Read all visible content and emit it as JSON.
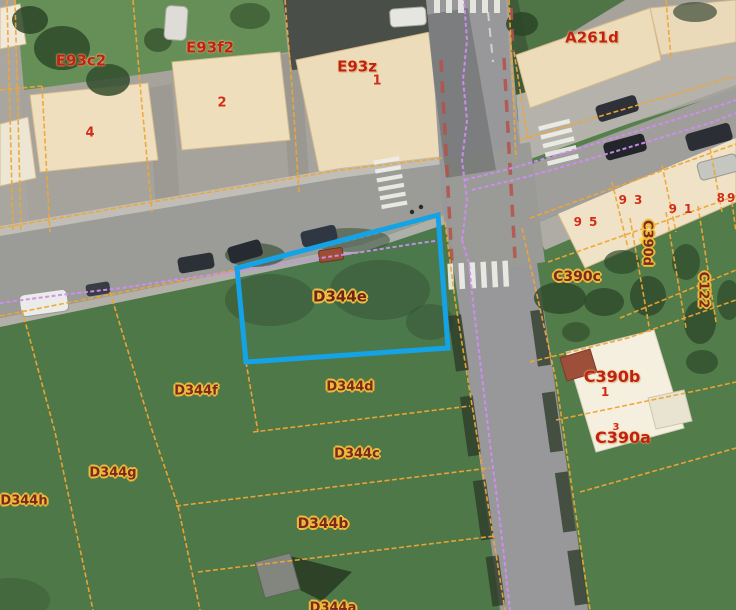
{
  "map": {
    "type": "aerial-cadastral-view",
    "selected_parcel": {
      "id": "D344e",
      "outline_color": "#15a3e8"
    },
    "colors": {
      "parcel_boundary_line": "#efa636",
      "utility_line": "#d08df2",
      "road_marking_red": "#b5524a",
      "selection_blue": "#15a3e8",
      "field_label_text": "#7b2a1e",
      "field_label_halo": "#eebb3a",
      "building_label_text": "#c0201a"
    },
    "labels": [
      {
        "id": "E93c2",
        "text": "E93c2",
        "x": 81,
        "y": 61,
        "style": "building",
        "size": 15
      },
      {
        "id": "house-4",
        "text": "4",
        "x": 90,
        "y": 133,
        "style": "number",
        "size": 13
      },
      {
        "id": "E93f2",
        "text": "E93f2",
        "x": 210,
        "y": 48,
        "style": "building",
        "size": 15
      },
      {
        "id": "house-2",
        "text": "2",
        "x": 222,
        "y": 103,
        "style": "number",
        "size": 13
      },
      {
        "id": "E93z",
        "text": "E93z",
        "x": 357,
        "y": 67,
        "style": "building",
        "size": 15
      },
      {
        "id": "house-1",
        "text": "1",
        "x": 377,
        "y": 81,
        "style": "number",
        "size": 13
      },
      {
        "id": "A261d",
        "text": "A261d",
        "x": 592,
        "y": 38,
        "style": "building",
        "size": 15
      },
      {
        "id": "no-95",
        "text": "95",
        "x": 589,
        "y": 222,
        "style": "number",
        "size": 12,
        "ls": 7
      },
      {
        "id": "no-93",
        "text": "93",
        "x": 634,
        "y": 200,
        "style": "number",
        "size": 12,
        "ls": 7
      },
      {
        "id": "no-91",
        "text": "91",
        "x": 684,
        "y": 209,
        "style": "number",
        "size": 12,
        "ls": 7
      },
      {
        "id": "no-89",
        "text": "89",
        "x": 727,
        "y": 198,
        "style": "number",
        "size": 12,
        "ls": 2
      },
      {
        "id": "C390d",
        "text": "C390d",
        "x": 647,
        "y": 243,
        "style": "field",
        "size": 13,
        "rotate": 90
      },
      {
        "id": "C390c",
        "text": "C390c",
        "x": 577,
        "y": 277,
        "style": "field",
        "size": 14
      },
      {
        "id": "C122",
        "text": "C122",
        "x": 703,
        "y": 290,
        "style": "field",
        "size": 13,
        "rotate": 90
      },
      {
        "id": "C390b",
        "text": "C390b",
        "x": 612,
        "y": 377,
        "style": "building",
        "size": 16
      },
      {
        "id": "house-1b",
        "text": "1",
        "x": 605,
        "y": 392,
        "style": "number",
        "size": 12
      },
      {
        "id": "house-3",
        "text": "3",
        "x": 616,
        "y": 428,
        "style": "number",
        "size": 10
      },
      {
        "id": "C390a",
        "text": "C390a",
        "x": 623,
        "y": 438,
        "style": "building",
        "size": 16
      },
      {
        "id": "D344e",
        "text": "D344e",
        "x": 340,
        "y": 297,
        "style": "field-selected",
        "size": 15
      },
      {
        "id": "D344f",
        "text": "D344f",
        "x": 196,
        "y": 391,
        "style": "field",
        "size": 13
      },
      {
        "id": "D344d",
        "text": "D344d",
        "x": 350,
        "y": 387,
        "style": "field",
        "size": 13
      },
      {
        "id": "D344c",
        "text": "D344c",
        "x": 357,
        "y": 454,
        "style": "field",
        "size": 13
      },
      {
        "id": "D344g",
        "text": "D344g",
        "x": 113,
        "y": 473,
        "style": "field",
        "size": 13
      },
      {
        "id": "D344h",
        "text": "D344h",
        "x": 24,
        "y": 501,
        "style": "field",
        "size": 13
      },
      {
        "id": "D344b",
        "text": "D344b",
        "x": 323,
        "y": 524,
        "style": "field",
        "size": 14
      },
      {
        "id": "D344a",
        "text": "D344a",
        "x": 333,
        "y": 608,
        "style": "field",
        "size": 13
      }
    ]
  }
}
